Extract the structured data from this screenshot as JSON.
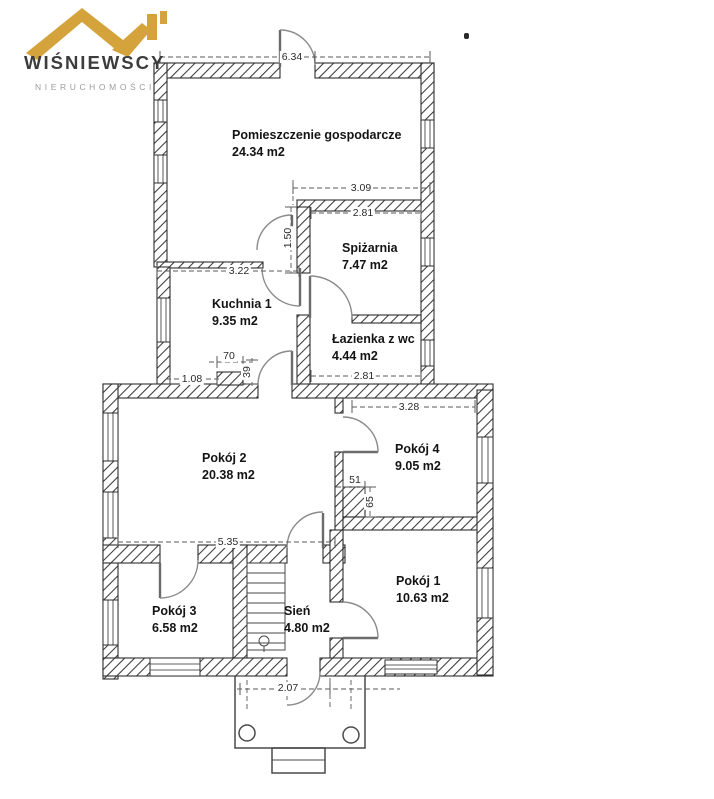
{
  "brand": {
    "name": "WIŚNIEWSCY",
    "subtitle": "NIERUCHOMOŚCI"
  },
  "plan": {
    "rooms": [
      {
        "name": "Pomieszczenie gospodarcze",
        "area": "24.34 m2"
      },
      {
        "name": "Spiżarnia",
        "area": "7.47 m2"
      },
      {
        "name": "Kuchnia 1",
        "area": "9.35 m2"
      },
      {
        "name": "Łazienka z wc",
        "area": "4.44 m2"
      },
      {
        "name": "Pokój 2",
        "area": "20.38 m2"
      },
      {
        "name": "Pokój 4",
        "area": "9.05 m2"
      },
      {
        "name": "Pokój 3",
        "area": "6.58 m2"
      },
      {
        "name": "Sień",
        "area": "4.80 m2"
      },
      {
        "name": "Pokój 1",
        "area": "10.63 m2"
      }
    ],
    "dims": {
      "top_entry": "6.34",
      "spizarnia_outer": "3.09",
      "spizarnia_inner": "2.81",
      "corridor_height": "1.50",
      "kuchnia_width": "3.22",
      "lazienka_width": "2.81",
      "pillar_width": "70",
      "pillar_offset": "1.08",
      "pillar_gap": "39",
      "pokoj4_width": "3.28",
      "stub_width": "51",
      "stub_height": "65",
      "pokoj2_width": "5.35",
      "entry_width": "2.07"
    }
  },
  "colors": {
    "roof_gold": "#D5A33C",
    "brand_text": "#3C3C3C",
    "subtitle_text": "#9B9B9B",
    "plan_ink": "#2E2E2E"
  }
}
